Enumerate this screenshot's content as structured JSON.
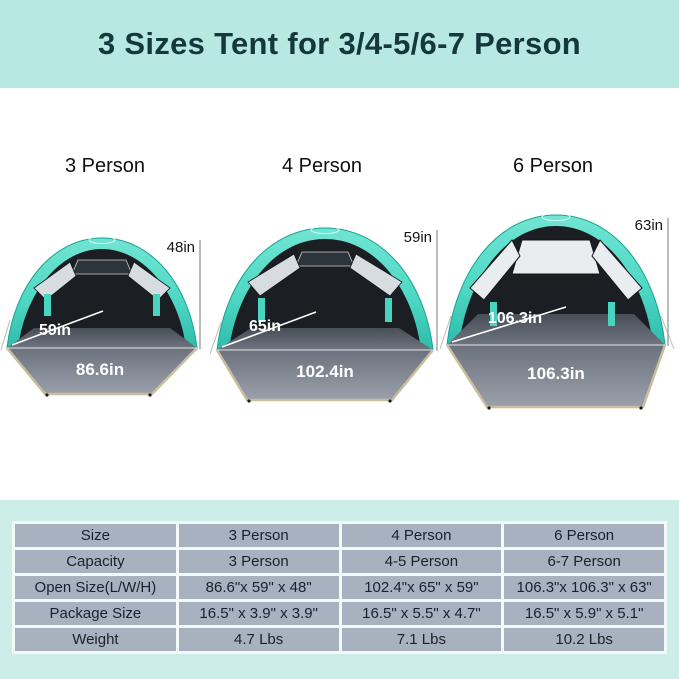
{
  "header": {
    "title": "3 Sizes Tent for 3/4-5/6-7 Person"
  },
  "tents": [
    {
      "label": "3 Person",
      "height": "48in",
      "depth": "59in",
      "width": "86.6in"
    },
    {
      "label": "4 Person",
      "height": "59in",
      "depth": "65in",
      "width": "102.4in"
    },
    {
      "label": "6 Person",
      "height": "63in",
      "depth": "106.3in",
      "width": "106.3in"
    }
  ],
  "table": {
    "rows": [
      {
        "label": "Size",
        "values": [
          "3 Person",
          "4 Person",
          "6 Person"
        ]
      },
      {
        "label": "Capacity",
        "values": [
          "3 Person",
          "4-5 Person",
          "6-7 Person"
        ]
      },
      {
        "label": "Open Size(L/W/H)",
        "values": [
          "86.6\"x 59\" x 48\"",
          "102.4\"x 65\" x 59\"",
          "106.3\"x 106.3\" x 63\""
        ]
      },
      {
        "label": "Package Size",
        "values": [
          "16.5\" x 3.9\" x 3.9\"",
          "16.5\" x 5.5\" x 4.7\"",
          "16.5\" x 5.9\" x 5.1\""
        ]
      },
      {
        "label": "Weight",
        "values": [
          "4.7 Lbs",
          "7.1 Lbs",
          "10.2 Lbs"
        ]
      }
    ]
  },
  "colors": {
    "banner_bg": "#b7e8e2",
    "banner_text": "#14383c",
    "panel_bg": "#cdeee8",
    "cell_bg": "#a7b1c0",
    "canopy_teal": "#4fd9c5",
    "floor_gray": "#8d94a0",
    "trim_tan": "#cabd9d"
  }
}
